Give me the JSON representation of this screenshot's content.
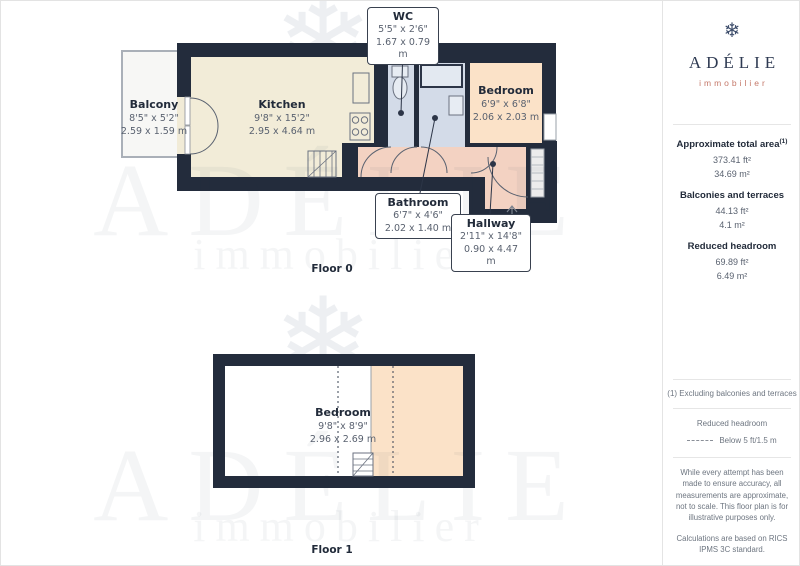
{
  "floors": [
    {
      "label": "Floor 0",
      "rooms": [
        {
          "name": "Balcony",
          "dims_ft": "8'5\" x 5'2\"",
          "dims_m": "2.59 x 1.59 m"
        },
        {
          "name": "Kitchen",
          "dims_ft": "9'8\" x 15'2\"",
          "dims_m": "2.95 x 4.64 m"
        },
        {
          "name": "WC",
          "dims_ft": "5'5\" x 2'6\"",
          "dims_m": "1.67 x 0.79 m"
        },
        {
          "name": "Bedroom",
          "dims_ft": "6'9\" x 6'8\"",
          "dims_m": "2.06 x 2.03 m"
        },
        {
          "name": "Bathroom",
          "dims_ft": "6'7\" x 4'6\"",
          "dims_m": "2.02 x 1.40 m"
        },
        {
          "name": "Hallway",
          "dims_ft": "2'11\" x 14'8\"",
          "dims_m": "0.90 x 4.47 m"
        }
      ]
    },
    {
      "label": "Floor 1",
      "rooms": [
        {
          "name": "Bedroom",
          "dims_ft": "9'8\" x 8'9\"",
          "dims_m": "2.96 x 2.69 m"
        }
      ]
    }
  ],
  "watermark": {
    "name": "ADÉLIE",
    "tagline": "immobilier",
    "snowflake_icon": "❄"
  },
  "sidebar": {
    "brand": {
      "name": "ADÉLIE",
      "tagline": "immobilier"
    },
    "areas": [
      {
        "label": "Approximate total area",
        "sup": "(1)",
        "ft": "373.41 ft²",
        "m": "34.69 m²"
      },
      {
        "label": "Balconies and terraces",
        "ft": "44.13 ft²",
        "m": "4.1 m²"
      },
      {
        "label": "Reduced headroom",
        "ft": "69.89 ft²",
        "m": "6.49 m²"
      }
    ],
    "footnote": "(1) Excluding balconies and terraces",
    "legend": {
      "title": "Reduced headroom",
      "item": "Below 5 ft/1.5 m"
    },
    "disclaimer1": "While every attempt has been made to ensure accuracy, all measurements are approximate, not to scale. This floor plan is for illustrative purposes only.",
    "disclaimer2": "Calculations are based on RICS IPMS 3C standard.",
    "brand_footer": {
      "name": "GIRAFFE",
      "suffix": "360"
    }
  },
  "colors": {
    "wall": "#232c3c",
    "kitchen": "#f2ecd8",
    "bedroom": "#fbe2c8",
    "hallway": "#f3d2c2",
    "wet_room": "#d3dbe8",
    "balcony": "#f7f7f5",
    "brand_navy": "#2e3a52",
    "brand_coral": "#c5796a"
  }
}
